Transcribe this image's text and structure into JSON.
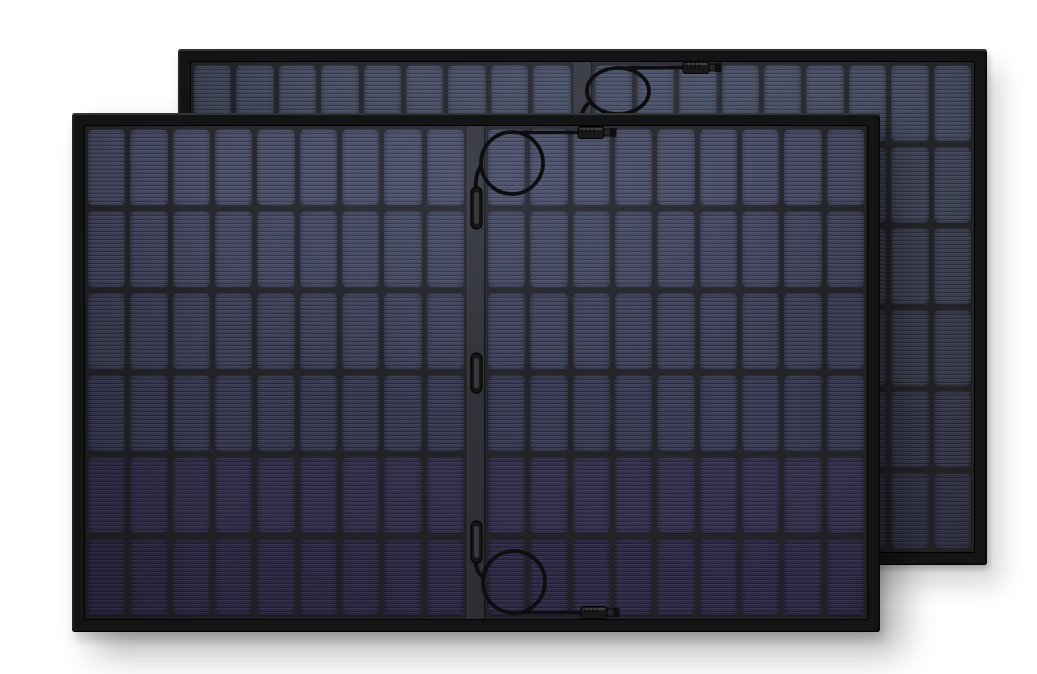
{
  "scene": {
    "width": 1037,
    "height": 674,
    "background_color": "#ffffff",
    "description": "Product render of two identical black-framed rigid monocrystalline solar panels on a white background; the rear panel is offset up and to the right behind the front panel. Each panel has a 6-row by 18-column cell grid split by a central vertical rail carrying coiled junction cables with MC4-style connectors."
  },
  "panel_style": {
    "frame_color": "#141414",
    "frame_highlight_color": "#343434",
    "frame_thickness": 13,
    "gap_color": "#25252a",
    "rail_color": "#33343b",
    "rail_width": 18,
    "cell_gap": 5,
    "cell_corner_radius": 6,
    "rows": 6,
    "cols_per_half": 9,
    "cable_color": "#0e0e10",
    "connector_body_color": "#191919",
    "connector_tip_color": "#242424",
    "clip_body_color": "#151515",
    "clip_core_color": "#3d3d3d"
  },
  "panels": [
    {
      "name": "back-solar-panel",
      "x": 178,
      "y": 49,
      "width": 809,
      "height": 516,
      "z": 1,
      "shadow": "14px 20px 26px rgba(0,0,0,0.16), 2px 4px 6px rgba(0,0,0,0.22)",
      "row_colors": [
        "#464c60",
        "#43485b",
        "#404456",
        "#3d4052",
        "#3a3c4e",
        "#37384a"
      ],
      "clips": [],
      "cables": [
        {
          "lead_path": "M 403 70 C 404 63 406 58 410 55",
          "loop": {
            "cx": 440,
            "cy": 42,
            "rx": 31,
            "ry": 23
          },
          "wire": {
            "x1": 440,
            "y1": 19,
            "x2": 505,
            "y2": 18.5
          },
          "connector": {
            "x": 505,
            "cy": 18.5
          }
        }
      ]
    },
    {
      "name": "front-solar-panel",
      "x": 72,
      "y": 113,
      "width": 808,
      "height": 519,
      "z": 2,
      "shadow": "22px 20px 36px rgba(0,0,0,0.30), 4px 8px 10px rgba(0,0,0,0.18)",
      "row_colors": [
        "#484b63",
        "#44475e",
        "#40435a",
        "#3c3e56",
        "#383551",
        "#342f4c"
      ],
      "clips": [
        {
          "x": 399,
          "y": 74,
          "w": 11,
          "h": 42
        },
        {
          "x": 399,
          "y": 240,
          "w": 11,
          "h": 40
        },
        {
          "x": 399,
          "y": 408,
          "w": 11,
          "h": 42
        }
      ],
      "cables": [
        {
          "lead_path": "M 404 78 C 403 66 405 59 409 53",
          "loop": {
            "cx": 440,
            "cy": 50,
            "rx": 31,
            "ry": 31
          },
          "wire": {
            "x1": 440,
            "y1": 19.5,
            "x2": 506,
            "y2": 19.5
          },
          "connector": {
            "x": 506,
            "cy": 19.5
          }
        },
        {
          "lead_path": "M 404 449 C 404 456 406 460 410 463",
          "loop": {
            "cx": 442,
            "cy": 469,
            "rx": 31,
            "ry": 31
          },
          "wire": {
            "x1": 442,
            "y1": 499.5,
            "x2": 509,
            "y2": 499.5
          },
          "connector": {
            "x": 509,
            "cy": 499.5
          }
        }
      ]
    }
  ]
}
